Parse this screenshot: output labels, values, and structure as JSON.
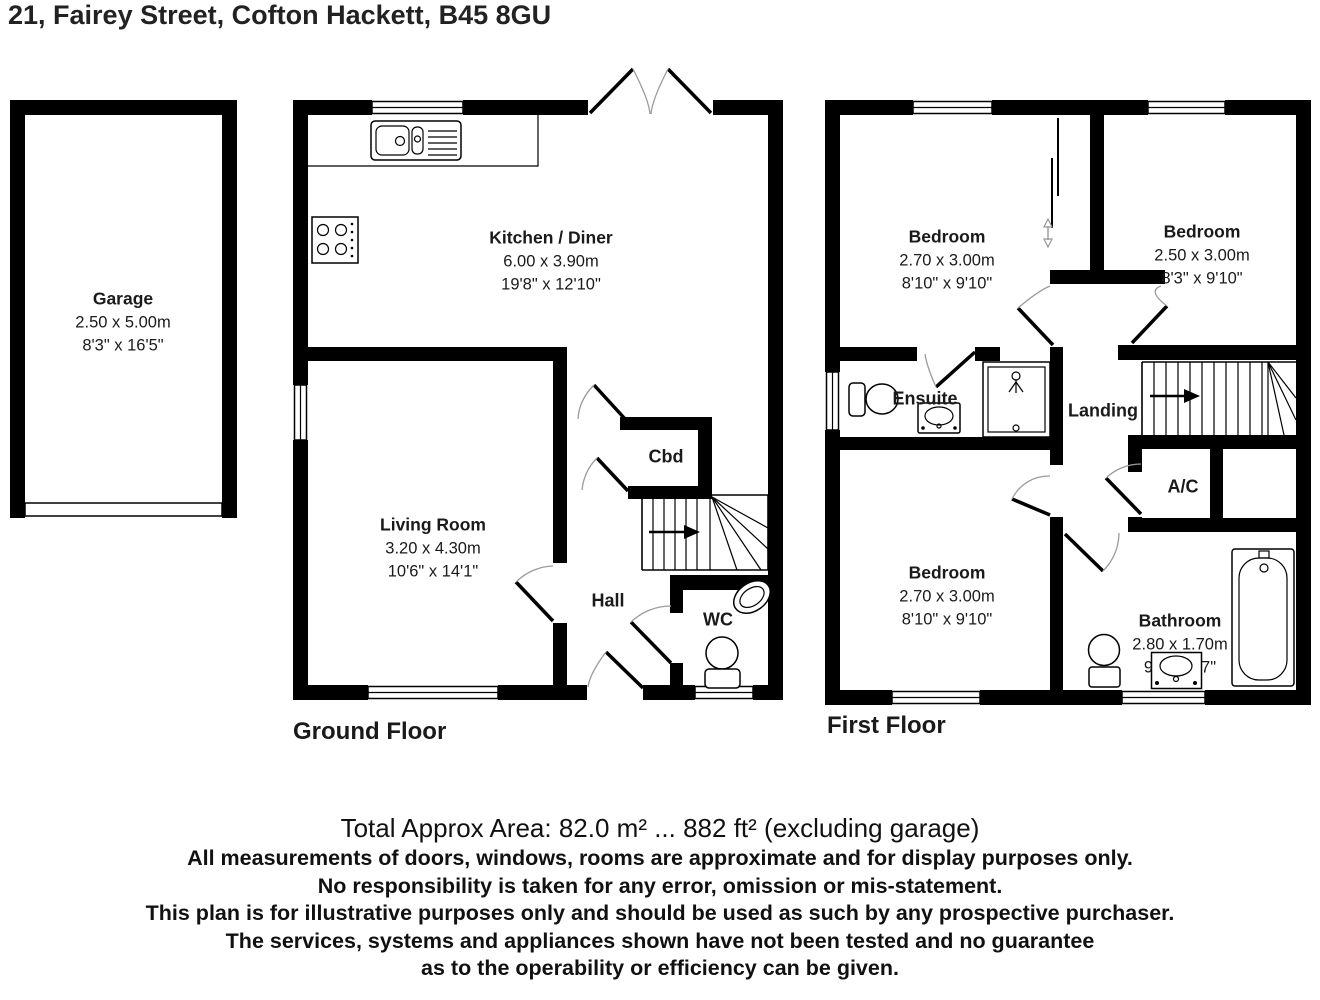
{
  "title": "21, Fairey Street, Cofton Hackett, B45 8GU",
  "floors": {
    "ground": {
      "label": "Ground Floor",
      "rooms": {
        "garage": {
          "name": "Garage",
          "metric": "2.50 x 5.00m",
          "imperial": "8'3\" x 16'5\""
        },
        "kitchen": {
          "name": "Kitchen / Diner",
          "metric": "6.00 x 3.90m",
          "imperial": "19'8\" x 12'10\""
        },
        "living": {
          "name": "Living Room",
          "metric": "3.20 x 4.30m",
          "imperial": "10'6\" x 14'1\""
        },
        "cbd": {
          "name": "Cbd"
        },
        "hall": {
          "name": "Hall"
        },
        "wc": {
          "name": "WC"
        }
      }
    },
    "first": {
      "label": "First Floor",
      "rooms": {
        "bedroom1": {
          "name": "Bedroom",
          "metric": "2.70 x 3.00m",
          "imperial": "8'10\" x 9'10\""
        },
        "bedroom2": {
          "name": "Bedroom",
          "metric": "2.50 x 3.00m",
          "imperial": "8'3\" x 9'10\""
        },
        "ensuite": {
          "name": "Ensuite"
        },
        "landing": {
          "name": "Landing"
        },
        "ac": {
          "name": "A/C"
        },
        "bedroom3": {
          "name": "Bedroom",
          "metric": "2.70 x 3.00m",
          "imperial": "8'10\" x 9'10\""
        },
        "bathroom": {
          "name": "Bathroom",
          "metric": "2.80 x 1.70m",
          "imperial": "9'2\" x 5'7\""
        }
      }
    }
  },
  "footer": {
    "area_line": "Total Approx Area: 82.0 m² ... 882 ft² (excluding garage)",
    "disclaimer": [
      "All measurements of doors, windows, rooms are approximate and for display purposes only.",
      "No responsibility is taken for any error, omission or mis-statement.",
      "This plan is for illustrative purposes only and should be used as such by any prospective purchaser.",
      "The services, systems and appliances shown have not been tested and no guarantee",
      "as to the operability or efficiency can be given."
    ]
  },
  "colors": {
    "wall": "#000000",
    "door_arc": "#9b9b9b",
    "text": "#1a1a1a"
  }
}
